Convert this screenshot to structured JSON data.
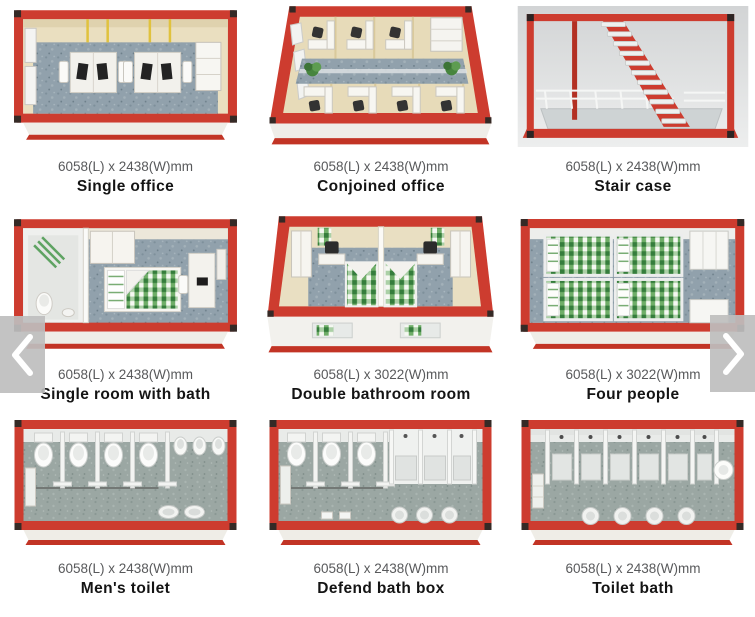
{
  "gallery": {
    "products": [
      {
        "dimensions": "6058(L) x 2438(W)mm",
        "name": "Single office"
      },
      {
        "dimensions": "6058(L) x 2438(W)mm",
        "name": "Conjoined office"
      },
      {
        "dimensions": "6058(L) x 2438(W)mm",
        "name": "Stair case"
      },
      {
        "dimensions": "6058(L) x 2438(W)mm",
        "name": "Single room with bath"
      },
      {
        "dimensions": "6058(L) x 3022(W)mm",
        "name": "Double bathroom room"
      },
      {
        "dimensions": "6058(L) x 3022(W)mm",
        "name": "Four people"
      },
      {
        "dimensions": "6058(L) x 2438(W)mm",
        "name": "Men's toilet"
      },
      {
        "dimensions": "6058(L) x 2438(W)mm",
        "name": "Defend bath box"
      },
      {
        "dimensions": "6058(L) x 2438(W)mm",
        "name": "Toilet bath"
      }
    ],
    "nav": {
      "prev_icon": "chevron-left",
      "next_icon": "chevron-right"
    },
    "colors": {
      "frame_red": "#cd3c2f",
      "wall_cream": "#e9dfc2",
      "floor_blue_grey": "#91a1ac",
      "floor_green_grey": "#9ba7a3",
      "bed_green": "#6fae68",
      "arrow_bg": "#bebebe",
      "dims_text": "#58595b",
      "name_text": "#141414"
    }
  }
}
